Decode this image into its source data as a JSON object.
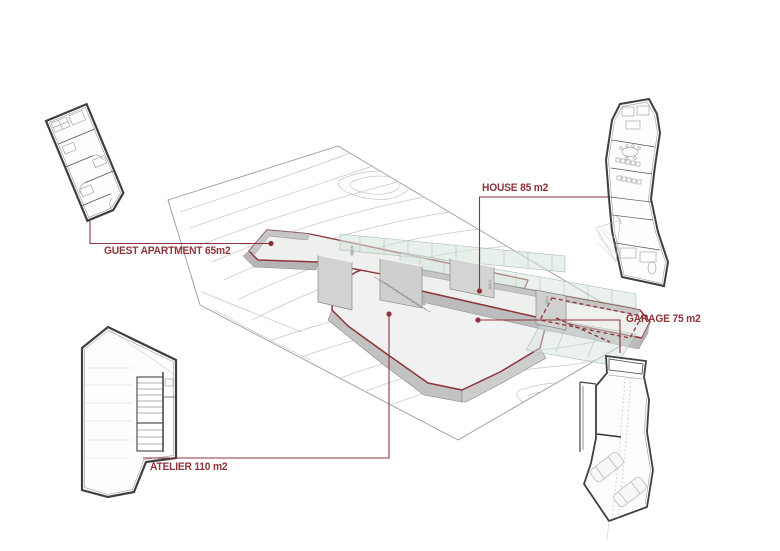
{
  "diagram": {
    "type": "architectural-axonometric-area-diagram",
    "background_color": "#ffffff",
    "accent_color": "#8e3438",
    "labels": {
      "guest_apartment": "GUEST APARTMENT 65m2",
      "house": "HOUSE 85 m2",
      "garage": "GARAGE 75 m2",
      "atelier": "ATELIER 110 m2"
    },
    "areas": [
      {
        "unit": "GUEST APARTMENT",
        "area_m2": 65
      },
      {
        "unit": "HOUSE",
        "area_m2": 85
      },
      {
        "unit": "GARAGE",
        "area_m2": 75
      },
      {
        "unit": "ATELIER",
        "area_m2": 110
      }
    ]
  }
}
